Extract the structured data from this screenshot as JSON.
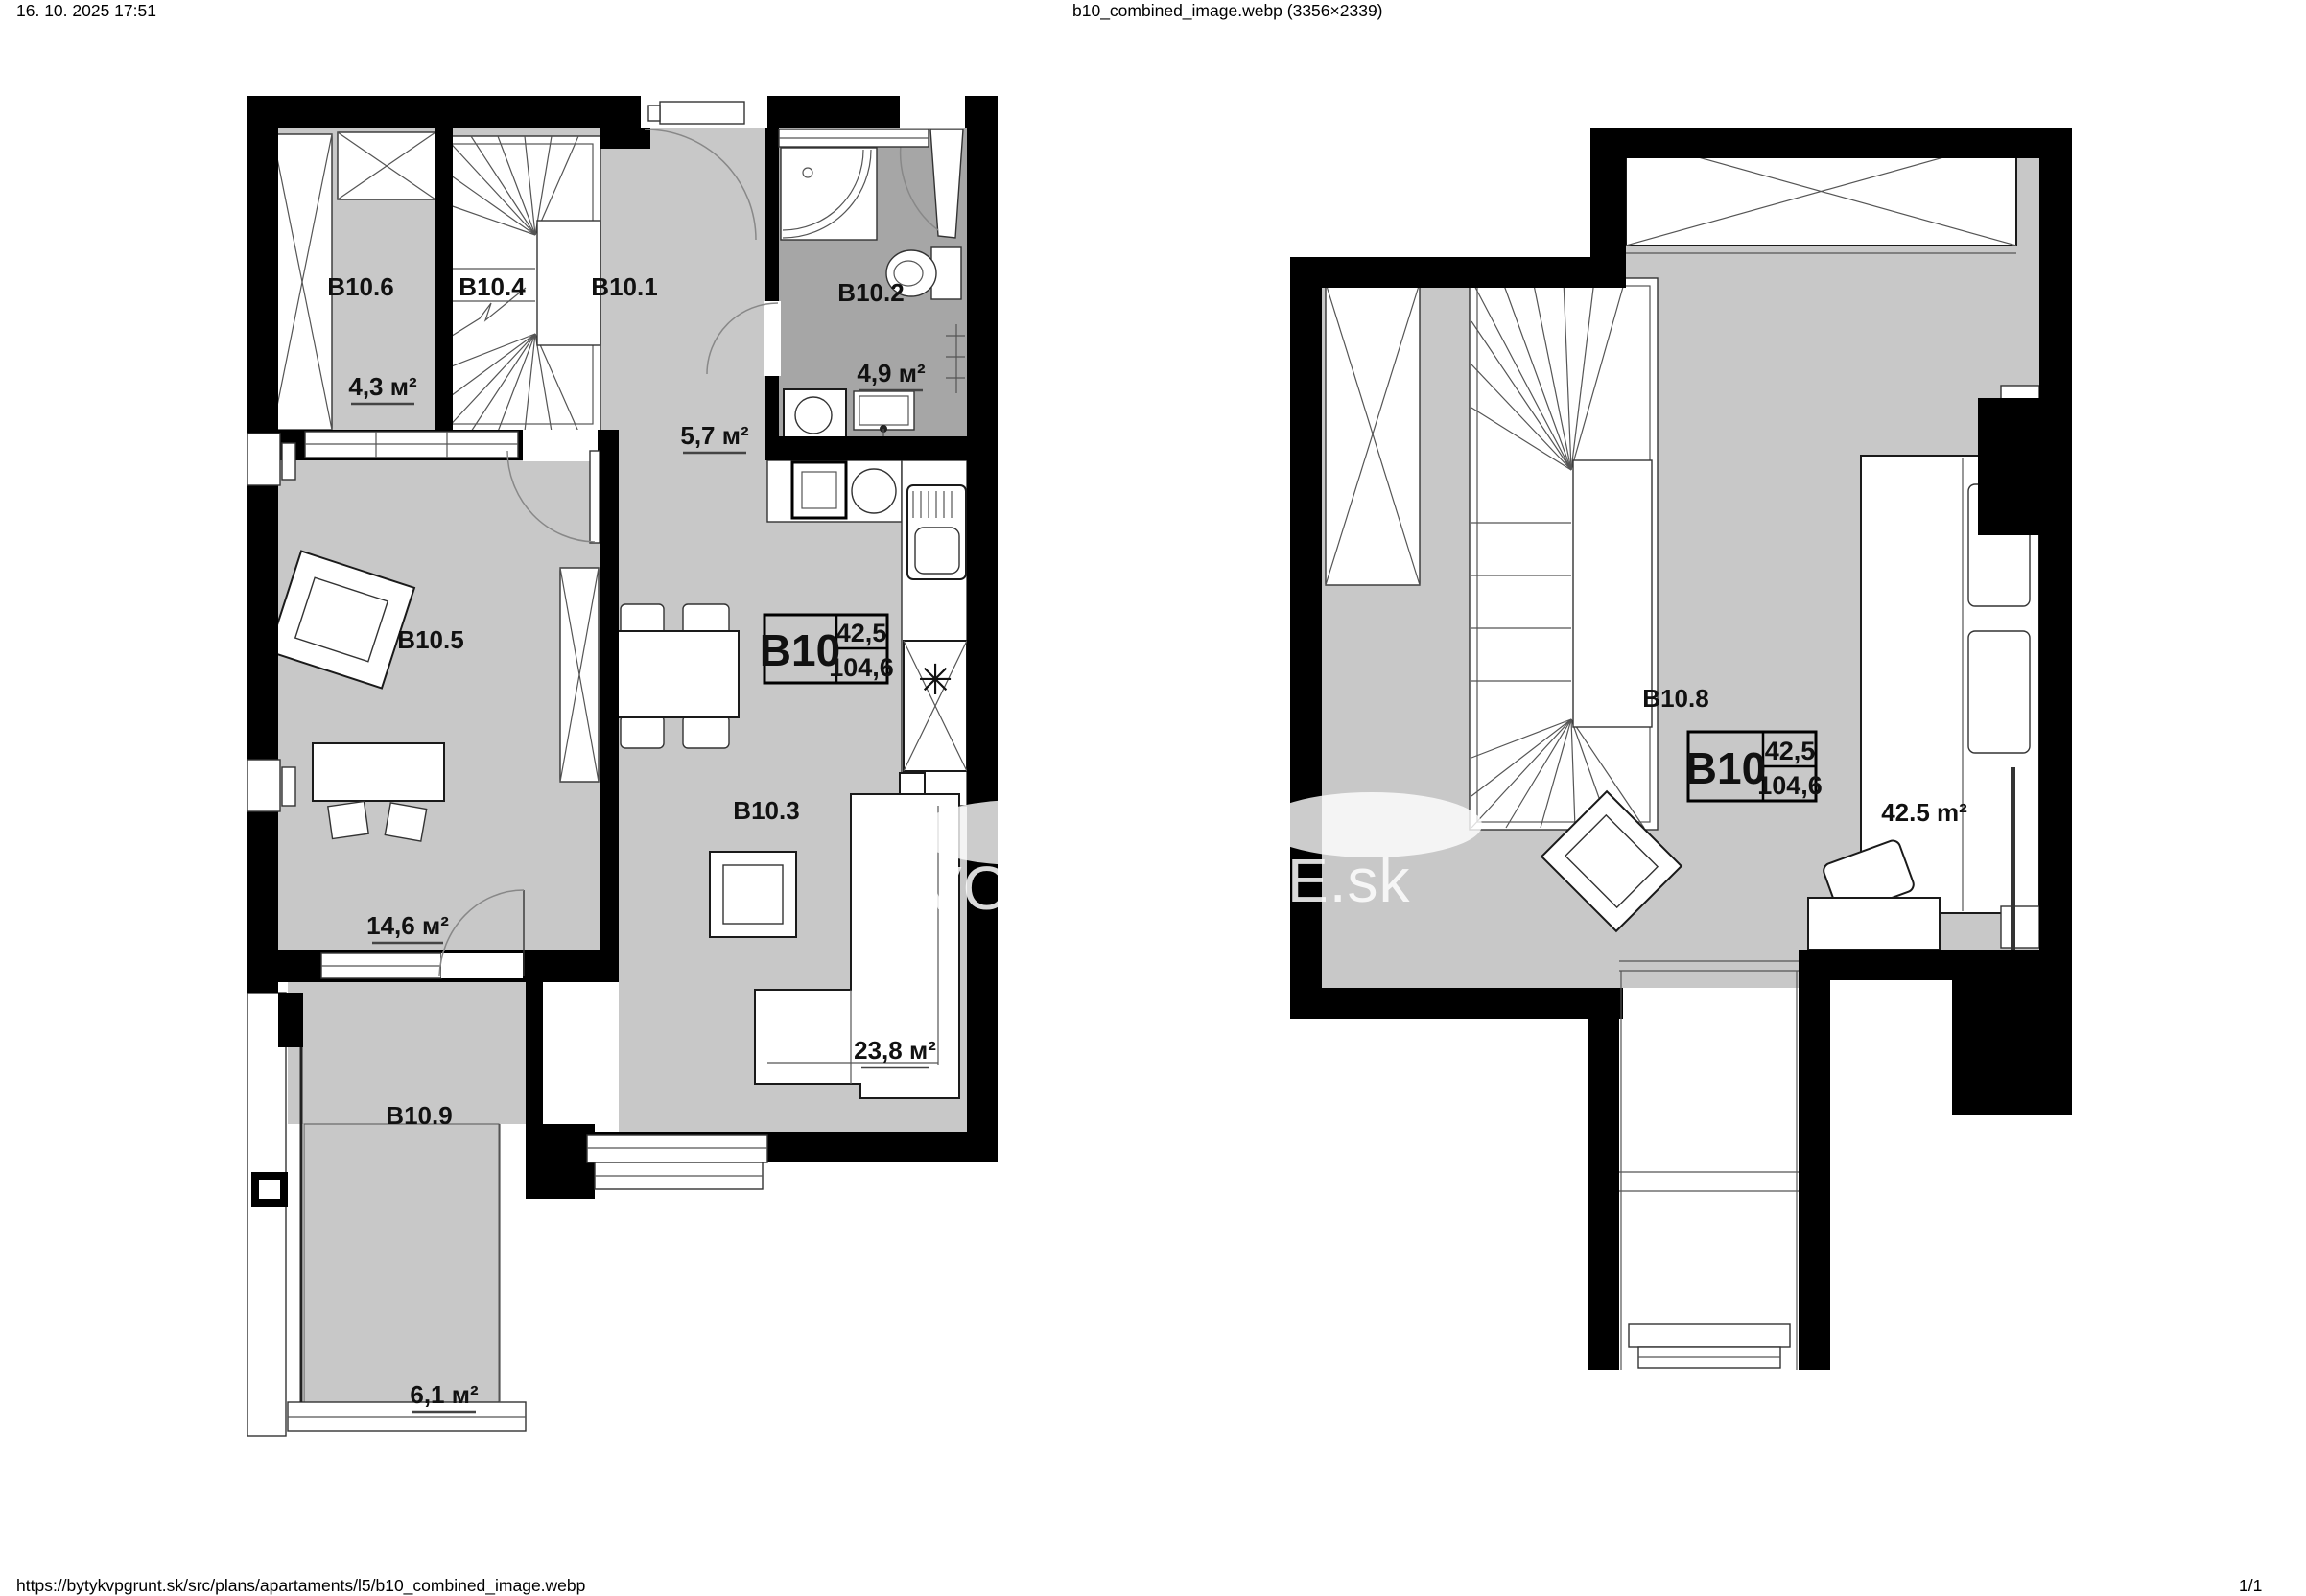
{
  "page": {
    "datetime": "16. 10. 2025 17:51",
    "title": "b10_combined_image.webp (3356×2339)",
    "url": "https://bytykvpgrunt.sk/src/plans/apartaments/l5/b10_combined_image.webp",
    "page_indicator": "1/1"
  },
  "unit": {
    "code": "B10",
    "area_floor": "42,5",
    "area_total": "104,6"
  },
  "ground_floor": {
    "b10_1": {
      "label": "B10.1",
      "area": "5,7 м²"
    },
    "b10_2": {
      "label": "B10.2",
      "area": "4,9 м²"
    },
    "b10_3": {
      "label": "B10.3",
      "area": "23,8 м²"
    },
    "b10_4": {
      "label": "B10.4"
    },
    "b10_5": {
      "label": "B10.5",
      "area": "14,6 м²"
    },
    "b10_6": {
      "label": "B10.6",
      "area": "4,3 м²"
    },
    "b10_9": {
      "label": "B10.9",
      "area": "6,1 м²"
    }
  },
  "upper_floor": {
    "b10_8": {
      "label": "B10.8",
      "area": "42.5 m²"
    }
  },
  "watermark": {
    "fragment_left": "VO",
    "fragment_right": "E.sk"
  },
  "symbols": {
    "fridge_asterisk": "✳"
  },
  "colors": {
    "floor": "#c8c8c8",
    "bathroom_floor": "#a6a6a6",
    "wall": "#000000"
  }
}
